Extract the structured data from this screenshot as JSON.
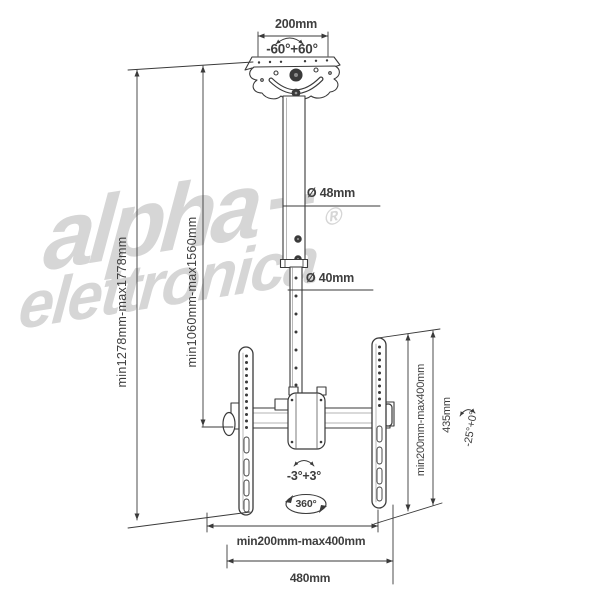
{
  "title": "TV ceiling mount technical drawing",
  "watermark": {
    "line1": "alpha",
    "plus": "+",
    "line2": "elettronica",
    "registered": "®"
  },
  "labels": {
    "top_width": "200mm",
    "swivel_range": "-60°+60°",
    "upper_pole_diameter": "Ø 48mm",
    "lower_pole_diameter": "Ø 40mm",
    "overall_height": "min1278mm-max1778mm",
    "pole_height": "min1060mm-max1560mm",
    "screen_tilt_fine": "-3°+3°",
    "rotation": "360°",
    "vesa_width": "min200mm-max400mm",
    "total_width": "480mm",
    "vesa_height": "min200mm-max400mm",
    "bracket_height": "435mm",
    "tilt_range": "-25°+0°"
  },
  "colors": {
    "line": "#3a3a3a",
    "text": "#3e3e3e",
    "watermark": "#d6d6d6",
    "background": "#ffffff"
  }
}
